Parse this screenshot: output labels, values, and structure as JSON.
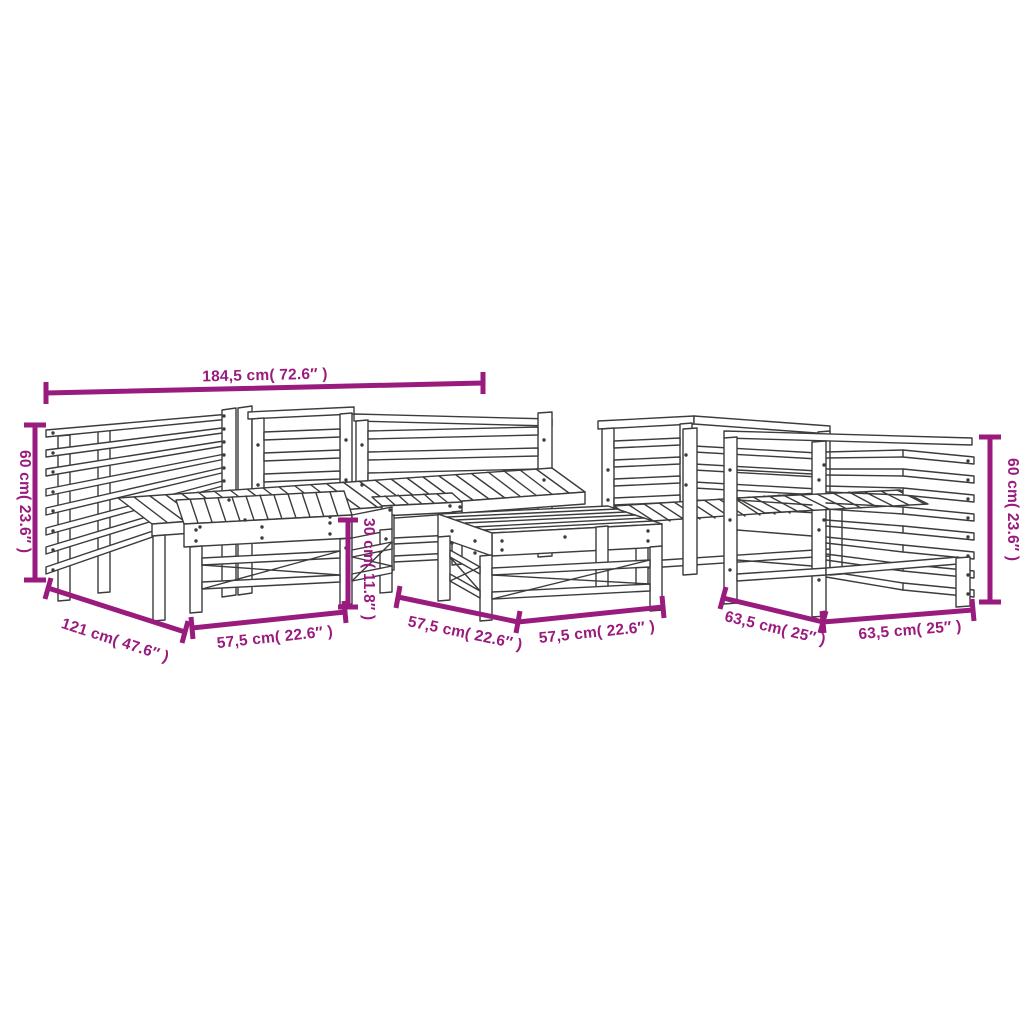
{
  "diagram": {
    "subject": "7-piece solid wood garden lounge set — dimension line drawing",
    "background_color": "#ffffff",
    "outline_color": "#3C3C3B",
    "dimension_color": "#9A1B7E"
  },
  "dims": {
    "total_width": "184,5 cm( 72.6″ )",
    "height_left": "60 cm( 23.6″ )",
    "height_right": "60 cm( 23.6″ )",
    "depth_sofa": "121 cm( 47.6″ )",
    "stool_height": "30 cm( 11.8″ )",
    "stool_width": "57,5 cm( 22.6″ )",
    "table_depth": "57,5 cm( 22.6″ )",
    "table_width": "57,5 cm( 22.6″ )",
    "chair_depth": "63,5 cm( 25″ )",
    "chair_width": "63,5 cm( 25″ )"
  }
}
